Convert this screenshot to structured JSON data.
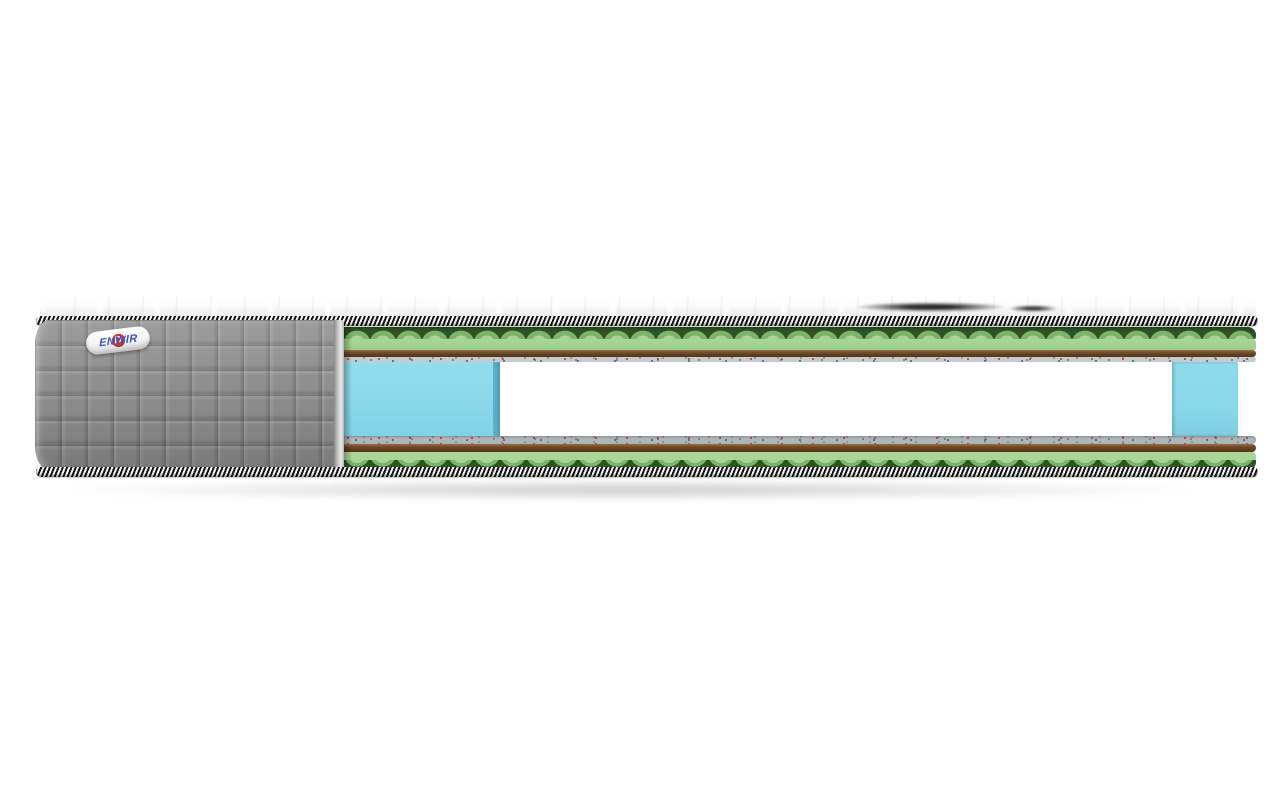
{
  "brand": {
    "initial": "D",
    "name_rest": "ENWIR"
  },
  "mattress": {
    "springs": {
      "count": 18
    },
    "colors": {
      "cover_gray": "#8f8f8f",
      "piping_dark": "#141414",
      "piping_light": "#f4f4f4",
      "foam_green": "#a9d698",
      "foam_green_mid": "#7cb46a",
      "foam_green_dark": "#2f5424",
      "coir_brown": "#6b4826",
      "coir_brown_dark": "#53351a",
      "felt_gray": "#c6cbce",
      "spring_light": "#e6e6e6",
      "side_foam_blue": "#8bd8e9",
      "side_foam_blue_dark": "#5fb6cc",
      "logo_red": "#d6342a",
      "logo_blue": "#3553c4",
      "top_white": "#f7f7f7"
    }
  }
}
